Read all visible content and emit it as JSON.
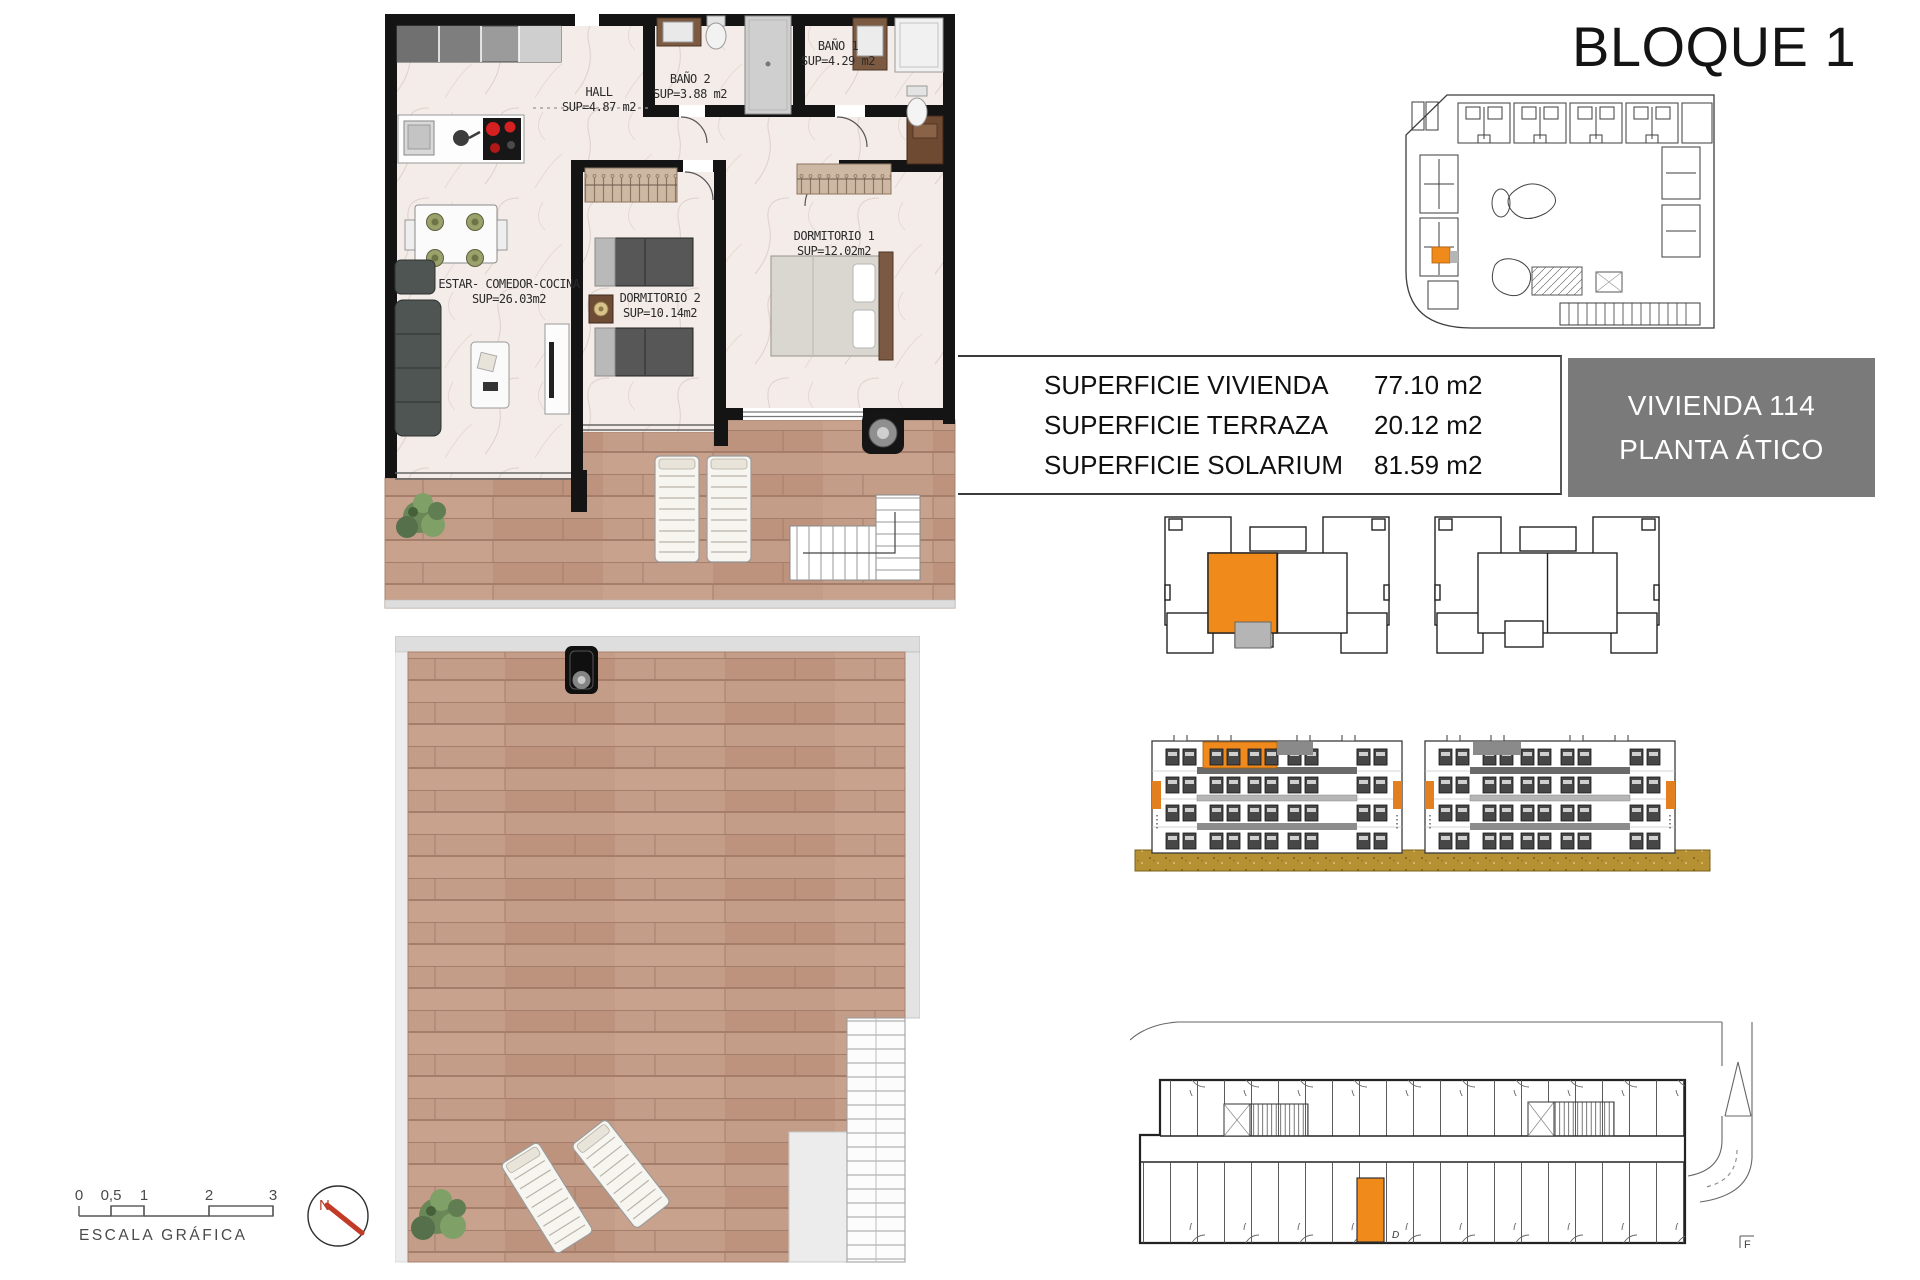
{
  "title": "BLOQUE 1",
  "floor_plan": {
    "rooms": [
      {
        "name": "HALL",
        "area": "SUP=4.87 m2"
      },
      {
        "name": "BAÑO 2",
        "area": "SUP=3.88 m2"
      },
      {
        "name": "BAÑO 1",
        "area": "SUP=4.29 m2"
      },
      {
        "name": "DORMITORIO 1",
        "area": "SUP=12.02m2"
      },
      {
        "name": "DORMITORIO 2",
        "area": "SUP=10.14m2"
      },
      {
        "name": "ESTAR- COMEDOR-COCINA",
        "area": "SUP=26.03m2"
      }
    ]
  },
  "area_table": {
    "rows": [
      {
        "label": "SUPERFICIE VIVIENDA",
        "value": "77.10 m2"
      },
      {
        "label": "SUPERFICIE TERRAZA",
        "value": "20.12 m2"
      },
      {
        "label": "SUPERFICIE SOLARIUM",
        "value": "81.59 m2"
      }
    ]
  },
  "unit_badge": {
    "line1": "VIVIENDA 114",
    "line2": "PLANTA ÁTICO"
  },
  "scale_bar": {
    "labels": [
      "0",
      "0,5",
      "1",
      "2",
      "3"
    ],
    "caption": "ESCALA GRÁFICA"
  },
  "compass": {
    "label": "N"
  },
  "marks": {
    "storage_letter": "D",
    "section_letter": "F"
  },
  "colors": {
    "highlight_orange": "#f08a1a",
    "terrace_gray": "#b5b5b5",
    "badge_gray": "#7a7a7a",
    "wood": "#c49d88",
    "ground_ochre": "#b69133"
  }
}
